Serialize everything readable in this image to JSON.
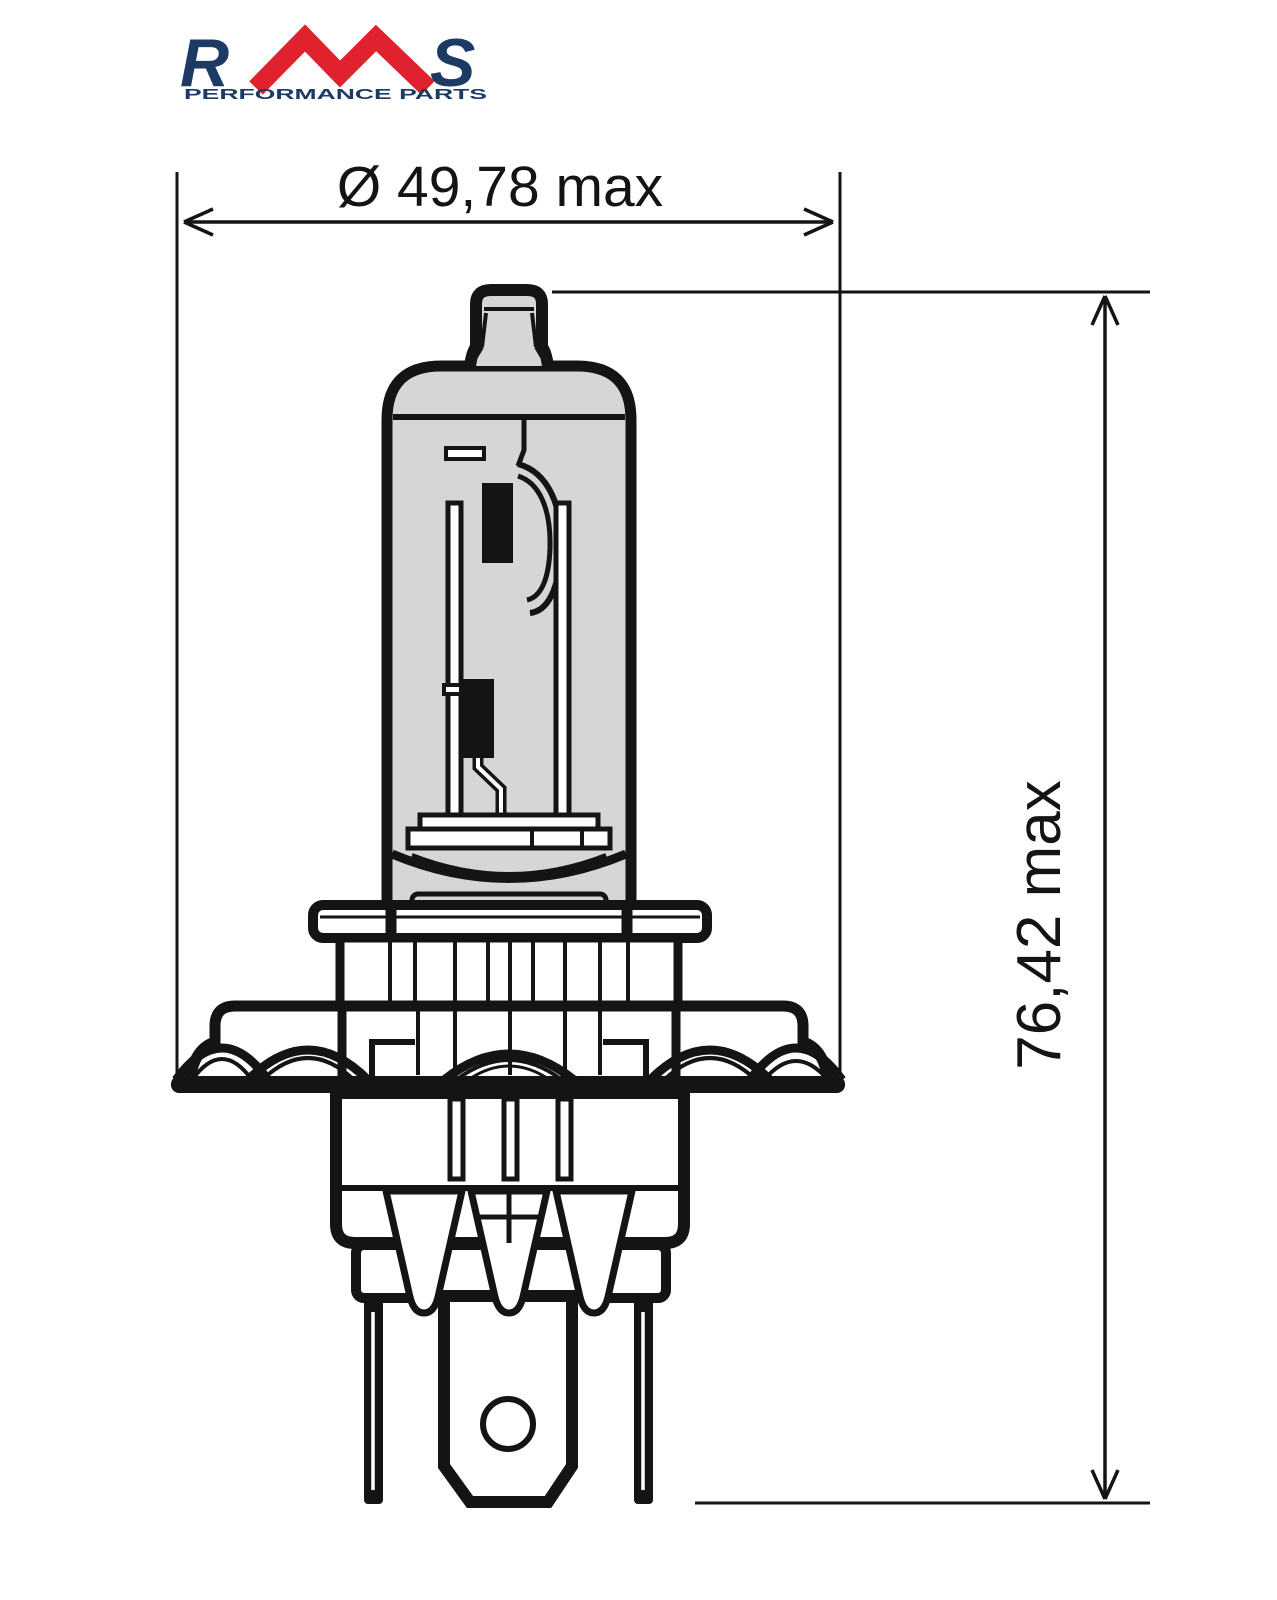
{
  "brand": {
    "letters": {
      "r": "R",
      "m": "M",
      "s": "S"
    },
    "sub_label": "SPA",
    "tagline": "PERFORMANCE PARTS",
    "colors": {
      "navy": "#1c3a64",
      "red": "#e0222e"
    }
  },
  "dimensions": {
    "diameter_label": "Ø 49,78 max",
    "height_label": "76,42 max",
    "text_color": "#141414"
  },
  "drawing": {
    "stroke_color": "#141414",
    "glass_fill": "#d6d6d6",
    "background": "#ffffff"
  }
}
